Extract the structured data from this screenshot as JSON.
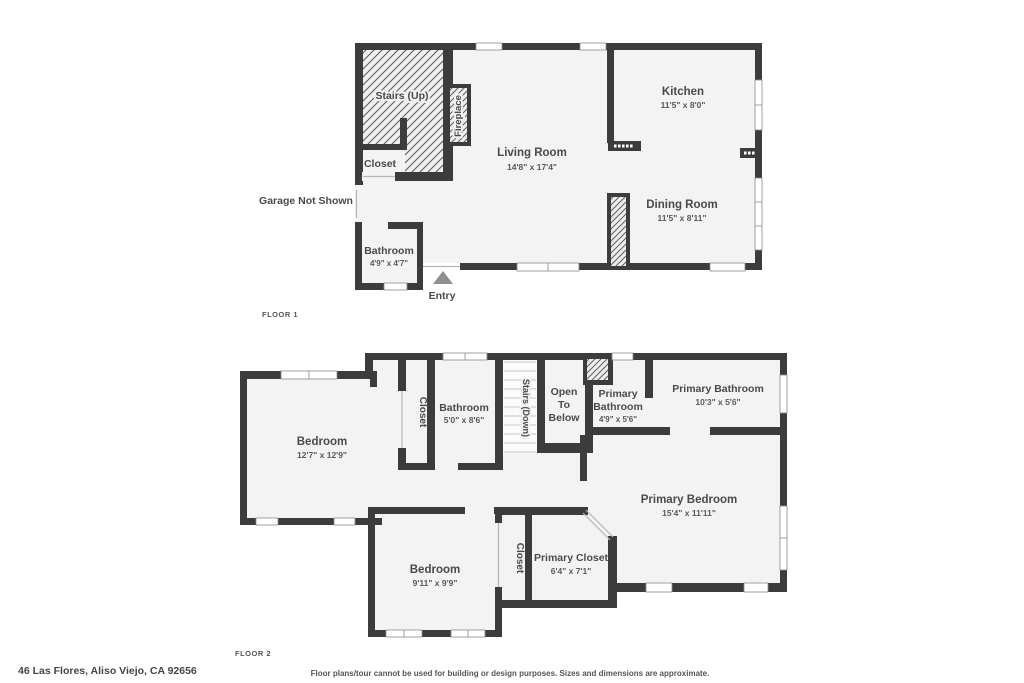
{
  "floor1": {
    "label": "FLOOR 1",
    "rooms": {
      "stairs": {
        "name": "Stairs (Up)"
      },
      "fireplace": {
        "name": "Fireplace"
      },
      "closet": {
        "name": "Closet"
      },
      "living": {
        "name": "Living Room",
        "dims": "14'8\" x 17'4\""
      },
      "kitchen": {
        "name": "Kitchen",
        "dims": "11'5\" x 8'0\""
      },
      "dining": {
        "name": "Dining Room",
        "dims": "11'5\" x 8'11\""
      },
      "bathroom": {
        "name": "Bathroom",
        "dims": "4'9\" x 4'7\""
      }
    },
    "annotations": {
      "garage": "Garage Not Shown",
      "entry": "Entry",
      "entry_marker": "triangle-up"
    }
  },
  "floor2": {
    "label": "FLOOR 2",
    "rooms": {
      "bedroom1": {
        "name": "Bedroom",
        "dims": "12'7\" x 12'9\""
      },
      "closet1": {
        "name": "Closet"
      },
      "bathroom": {
        "name": "Bathroom",
        "dims": "5'0\" x 8'6\""
      },
      "stairs": {
        "name": "Stairs (Down)"
      },
      "open_below": {
        "line1": "Open",
        "line2": "To",
        "line3": "Below"
      },
      "primary_bath_sm": {
        "line1": "Primary",
        "line2": "Bathroom",
        "dims": "4'9\" x 5'6\""
      },
      "primary_bath": {
        "name": "Primary Bathroom",
        "dims": "10'3\" x 5'6\""
      },
      "primary_bedroom": {
        "name": "Primary Bedroom",
        "dims": "15'4\" x 11'11\""
      },
      "bedroom2": {
        "name": "Bedroom",
        "dims": "9'11\" x 9'9\""
      },
      "closet2": {
        "name": "Closet"
      },
      "primary_closet": {
        "name": "Primary Closet",
        "dims": "6'4\" x 7'1\""
      }
    }
  },
  "footer": {
    "address": "46 Las Flores, Aliso Viejo, CA 92656",
    "disclaimer": "Floor plans/tour cannot be used for building or design purposes. Sizes and dimensions are approximate."
  },
  "colors": {
    "wall": "#3c3c3c",
    "room_fill": "#f3f3f3",
    "label_text": "#4a4a4a",
    "entry_marker": "#8f8f8f"
  }
}
